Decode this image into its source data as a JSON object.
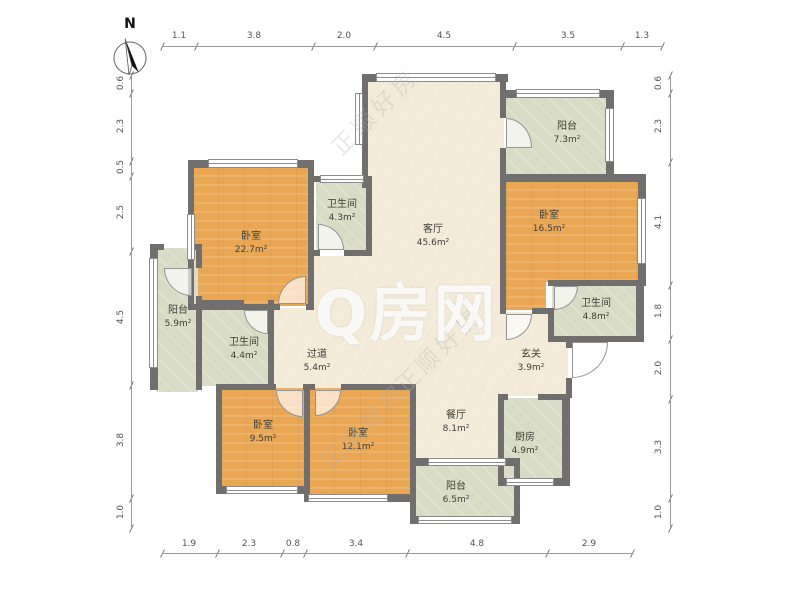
{
  "compass": {
    "north_label": "N"
  },
  "watermark": {
    "center": "Q房网",
    "diagonal": "正顺好房"
  },
  "rooms": {
    "bedroom_tl": {
      "name": "卧室",
      "area": "22.7m²"
    },
    "bath_tl": {
      "name": "卫生间",
      "area": "4.3m²"
    },
    "living": {
      "name": "客厅",
      "area": "45.6m²"
    },
    "balcony_tr": {
      "name": "阳台",
      "area": "7.3m²"
    },
    "bedroom_r": {
      "name": "卧室",
      "area": "16.5m²"
    },
    "bath_r": {
      "name": "卫生间",
      "area": "4.8m²"
    },
    "balcony_l": {
      "name": "阳台",
      "area": "5.9m²"
    },
    "bath_l": {
      "name": "卫生间",
      "area": "4.4m²"
    },
    "hallway": {
      "name": "过道",
      "area": "5.4m²"
    },
    "entry": {
      "name": "玄关",
      "area": "3.9m²"
    },
    "dining": {
      "name": "餐厅",
      "area": "8.1m²"
    },
    "kitchen": {
      "name": "厨房",
      "area": "4.9m²"
    },
    "bedroom_bl": {
      "name": "卧室",
      "area": "9.5m²"
    },
    "bedroom_bc": {
      "name": "卧室",
      "area": "12.1m²"
    },
    "balcony_b": {
      "name": "阳台",
      "area": "6.5m²"
    }
  },
  "dimensions": {
    "top": [
      "1.1",
      "3.8",
      "2.0",
      "4.5",
      "3.5",
      "1.3"
    ],
    "bottom": [
      "1.9",
      "2.3",
      "0.8",
      "3.4",
      "4.8",
      "2.9"
    ],
    "left": [
      "0.6",
      "2.3",
      "0.5",
      "2.5",
      "4.5",
      "3.8",
      "1.0"
    ],
    "right": [
      "0.6",
      "2.3",
      "4.1",
      "1.8",
      "2.0",
      "3.3",
      "1.0"
    ]
  },
  "colors": {
    "wall": "#716f6d",
    "bedroom_floor": "#e9a653",
    "balcony_floor": "#d8dcc4",
    "living_floor": "#f3ead7"
  }
}
